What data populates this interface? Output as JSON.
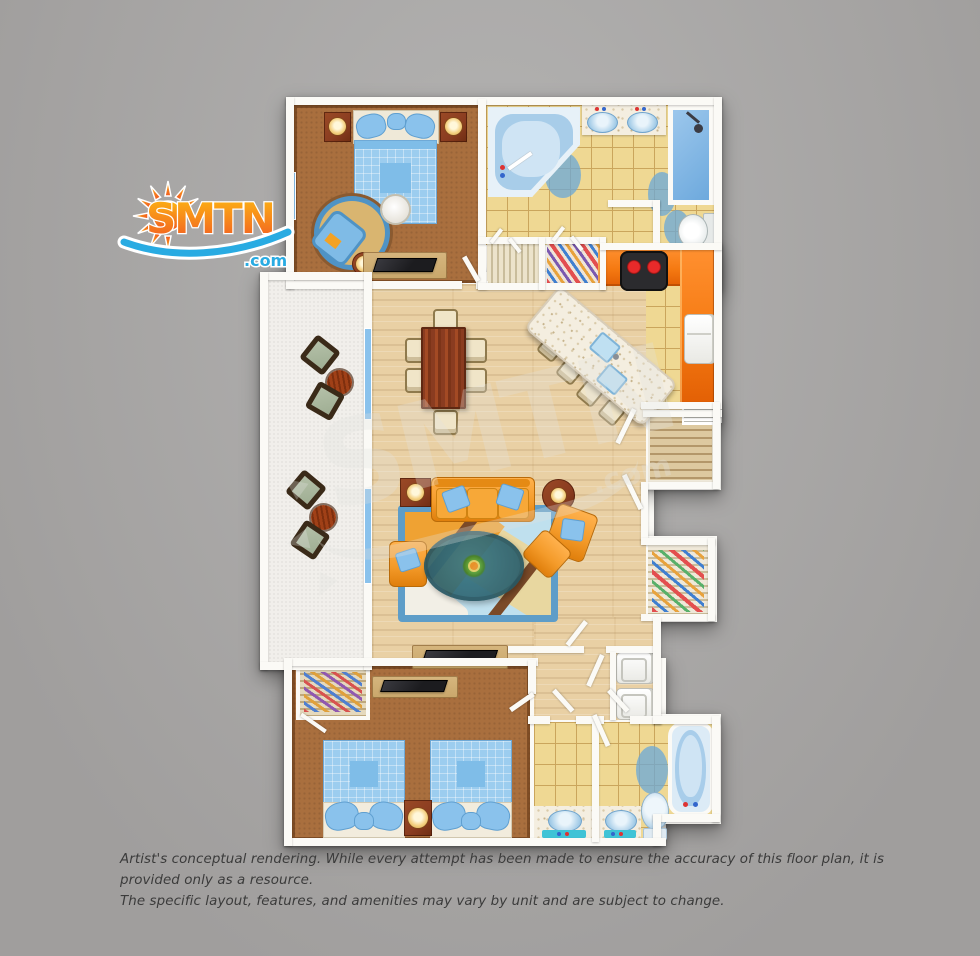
{
  "logo": {
    "brand": "SMTN",
    "tld": ".com"
  },
  "watermark": {
    "text": "SMTN",
    "tld": ".com"
  },
  "disclaimer": {
    "line1": "Artist's conceptual rendering. While every attempt has been made to ensure the accuracy of this floor plan, it is provided only as a resource.",
    "line2": "The specific layout, features, and amenities may vary by unit and are subject to change."
  },
  "colors": {
    "bg_top": "#b4b3b2",
    "bg_bottom": "#a09e9d",
    "wall": "#fbfaf6",
    "wood": "#e9d0a4",
    "carpet": "#a96f3e",
    "tile": "#efd893",
    "tile_line": "#caa55c",
    "granite": "#f4eee0",
    "counter_orange": "#f57a12",
    "fixture_blue": "#a9cfe9",
    "fixture_deep": "#6aa8d8",
    "soft_blue": "#8ac2ec",
    "sofa_orange": "#f49b2a",
    "rug_border_blue": "#5e9dc8",
    "table_teal": "#2e6e7c",
    "balcony": "#f1efeb",
    "sage": "#9fae93",
    "dark_wood": "#8a3c20",
    "tan_wood": "#c9a76b",
    "cream": "#f0e5c8",
    "tv_black": "#1c1c1f",
    "logo_orange": "#F7941E",
    "logo_orange_deep": "#F15A22",
    "logo_teal": "#29ABE2",
    "text_gray": "#3b3b3b"
  },
  "floor_plan": {
    "rooms": [
      {
        "name": "master-bedroom",
        "furniture": [
          "king-bed",
          "nightstand-left",
          "nightstand-right",
          "round-rug",
          "armchair",
          "side-table",
          "tv-console"
        ]
      },
      {
        "name": "master-bathroom",
        "furniture": [
          "corner-tub",
          "double-vanity",
          "shower",
          "toilet",
          "linen-closet",
          "wardrobe-closet"
        ]
      },
      {
        "name": "kitchen",
        "furniture": [
          "range",
          "refrigerator",
          "l-shaped-counter",
          "island-with-sinks",
          "bar-stools"
        ]
      },
      {
        "name": "dining-area",
        "furniture": [
          "dining-table",
          "dining-chairs-x6"
        ]
      },
      {
        "name": "living-room",
        "furniture": [
          "sofa",
          "armchair-left",
          "armchair-right",
          "ottoman",
          "coffee-table",
          "area-rug",
          "side-tables",
          "tv-console"
        ]
      },
      {
        "name": "balcony",
        "furniture": [
          "patio-chairs-x4",
          "patio-tables-x2"
        ]
      },
      {
        "name": "bedroom-2",
        "furniture": [
          "bed-left",
          "bed-right",
          "shared-nightstand",
          "tv-console",
          "closet"
        ]
      },
      {
        "name": "bathroom-2",
        "furniture": [
          "vanity-left",
          "vanity-right",
          "toilet",
          "bathtub"
        ]
      },
      {
        "name": "hallway",
        "furniture": [
          "washer",
          "dryer",
          "pantry",
          "coat-closet"
        ]
      }
    ]
  }
}
